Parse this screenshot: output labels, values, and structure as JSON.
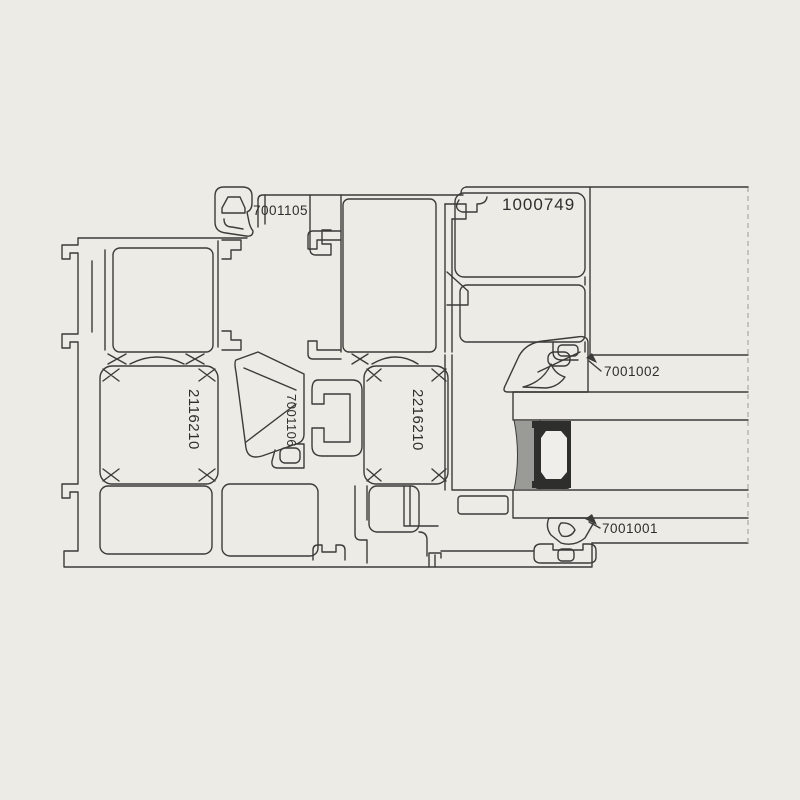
{
  "drawing": {
    "title": "window-profile-cross-section",
    "labels": {
      "clip": "7001105",
      "glazing_bead": "1000749",
      "frame_chamber": "2116210",
      "connector": "7001106",
      "sash_chamber": "2216210",
      "gasket_top": "7001002",
      "gasket_bottom": "7001001"
    },
    "colors": {
      "bg": "#ecebe6",
      "line": "#3b3b39",
      "sealant": "#9a9a96",
      "spacer": "#2e2e2c",
      "glass": "#efeeea",
      "dash": "#aaa9a4",
      "text": "#2e2e2c"
    }
  }
}
